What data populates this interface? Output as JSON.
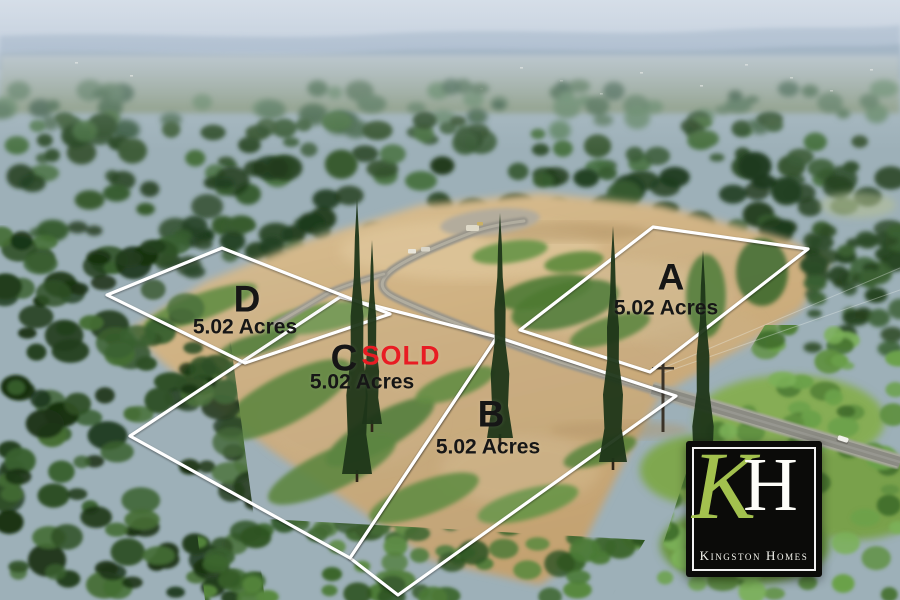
{
  "lots": [
    {
      "id": "A",
      "letter": "A",
      "acres": "5.02 Acres",
      "sold": false,
      "polygon": [
        [
          653,
          227
        ],
        [
          808,
          249
        ],
        [
          650,
          372
        ],
        [
          520,
          330
        ]
      ],
      "letter_pos": [
        671,
        277
      ],
      "acres_pos": [
        666,
        308
      ]
    },
    {
      "id": "B",
      "letter": "B",
      "acres": "5.02 Acres",
      "sold": false,
      "polygon": [
        [
          350,
          558
        ],
        [
          497,
          337
        ],
        [
          676,
          396
        ],
        [
          398,
          595
        ]
      ],
      "letter_pos": [
        491,
        414
      ],
      "acres_pos": [
        488,
        447
      ]
    },
    {
      "id": "C",
      "letter": "C",
      "acres": "5.02 Acres",
      "sold": true,
      "sold_label": "SOLD",
      "polygon": [
        [
          130,
          436
        ],
        [
          340,
          297
        ],
        [
          497,
          337
        ],
        [
          350,
          558
        ]
      ],
      "letter_pos": [
        344,
        358
      ],
      "acres_pos": [
        362,
        382
      ],
      "sold_pos": [
        401,
        356
      ]
    },
    {
      "id": "D",
      "letter": "D",
      "acres": "5.02 Acres",
      "sold": false,
      "polygon": [
        [
          107,
          295
        ],
        [
          222,
          248
        ],
        [
          390,
          314
        ],
        [
          245,
          363
        ]
      ],
      "letter_pos": [
        247,
        299
      ],
      "acres_pos": [
        245,
        327
      ]
    }
  ],
  "styles": {
    "outline_color": "#ffffff",
    "label_color": "#161616",
    "sold_color": "#e81c23"
  },
  "logo": {
    "monogram_k": "K",
    "monogram_h": "H",
    "name": "Kingston Homes",
    "background": "#0b0b09",
    "green": "#a3c14e",
    "text_color": "#f6f6ef"
  }
}
